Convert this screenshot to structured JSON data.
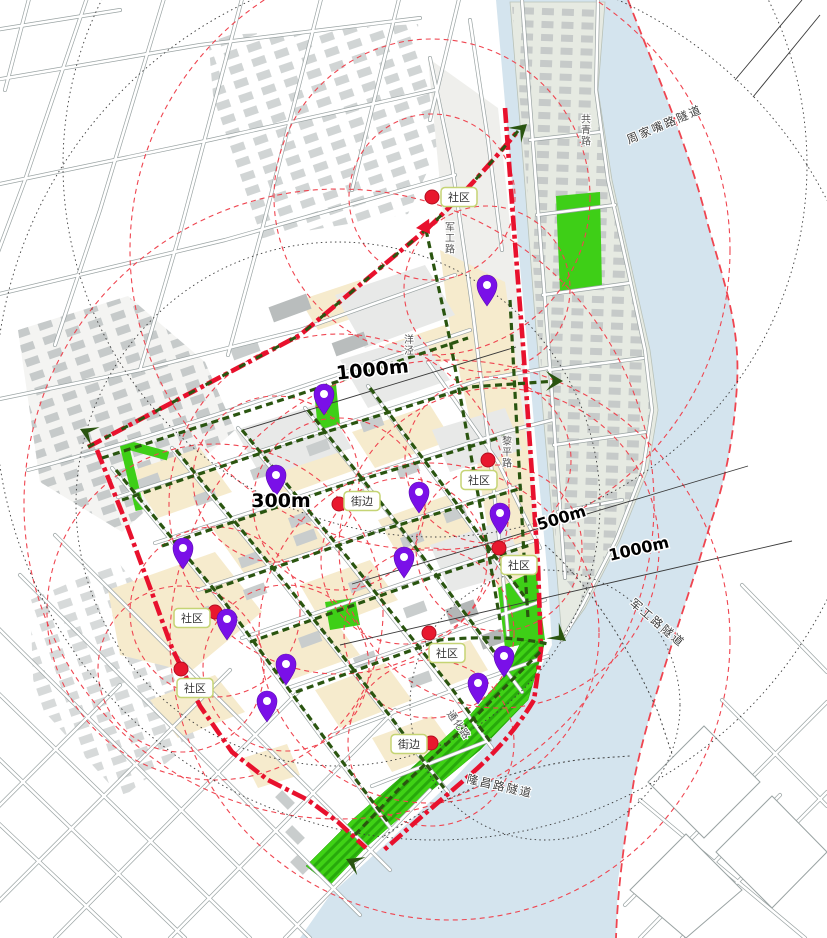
{
  "title": "滨江片区步行系统与服务半径分析图",
  "colors": {
    "boundary_red": "#e8112d",
    "route_green": "#2a5510",
    "radius_red": "#ef4550",
    "pin_purple": "#7a10e8",
    "poi_dot_red": "#e8182e",
    "water_blue": "#d4e4ee",
    "park_green": "#3ecf17",
    "block_tan": "#f6ebcd",
    "building_gray": "#c6caca"
  },
  "labels": {
    "distance": [
      {
        "text": "1000m",
        "x": 373,
        "y": 376,
        "rot": -6,
        "size": 19
      },
      {
        "text": "300m",
        "x": 281,
        "y": 507,
        "rot": 0,
        "size": 19
      },
      {
        "text": "500m",
        "x": 563,
        "y": 523,
        "rot": -17,
        "size": 16
      },
      {
        "text": "1000m",
        "x": 640,
        "y": 554,
        "rot": -13,
        "size": 16
      }
    ],
    "tunnels": [
      {
        "text": "周家嘴路隧道",
        "x": 666,
        "y": 128,
        "rot": -23
      },
      {
        "text": "军工路隧道",
        "x": 655,
        "y": 626,
        "rot": 40
      },
      {
        "text": "隆昌路隧道",
        "x": 499,
        "y": 790,
        "rot": 13
      }
    ],
    "roads": [
      {
        "text": "军工路",
        "x": 448,
        "y": 238,
        "vertical": true
      },
      {
        "text": "共青路",
        "x": 584,
        "y": 130,
        "vertical": true
      },
      {
        "text": "黎平路",
        "x": 505,
        "y": 452,
        "vertical": true
      },
      {
        "text": "洋泾",
        "x": 407,
        "y": 345,
        "vertical": true
      },
      {
        "text": "通化路",
        "x": 456,
        "y": 727,
        "rot": 55
      }
    ]
  },
  "markers": {
    "poi": [
      {
        "label": "社区",
        "dot": [
          432,
          197
        ],
        "box": [
          459,
          197
        ]
      },
      {
        "label": "社区",
        "dot": [
          488,
          460
        ],
        "box": [
          479,
          480
        ]
      },
      {
        "label": "社区",
        "dot": [
          499,
          548
        ],
        "box": [
          519,
          565
        ]
      },
      {
        "label": "街边",
        "dot": [
          339,
          504
        ],
        "box": [
          362,
          501
        ]
      },
      {
        "label": "社区",
        "dot": [
          215,
          612
        ],
        "box": [
          192,
          618
        ]
      },
      {
        "label": "社区",
        "dot": [
          181,
          669
        ],
        "box": [
          195,
          688
        ]
      },
      {
        "label": "社区",
        "dot": [
          429,
          633
        ],
        "box": [
          447,
          653
        ]
      },
      {
        "label": "街边",
        "dot": [
          431,
          743
        ],
        "box": [
          409,
          744
        ]
      }
    ],
    "pins": [
      [
        487,
        289
      ],
      [
        324,
        398
      ],
      [
        276,
        479
      ],
      [
        419,
        496
      ],
      [
        500,
        517
      ],
      [
        404,
        561
      ],
      [
        183,
        552
      ],
      [
        227,
        623
      ],
      [
        286,
        668
      ],
      [
        267,
        705
      ],
      [
        504,
        660
      ],
      [
        478,
        687
      ]
    ]
  },
  "circles": {
    "service": [
      {
        "c": [
          432,
          197
        ],
        "r": 83
      },
      {
        "c": [
          432,
          197
        ],
        "r": 158
      },
      {
        "c": [
          487,
          289
        ],
        "r": 83
      },
      {
        "c": [
          488,
          460
        ],
        "r": 83
      },
      {
        "c": [
          339,
          504
        ],
        "r": 86
      },
      {
        "c": [
          339,
          504
        ],
        "r": 170
      },
      {
        "c": [
          339,
          504
        ],
        "r": 315
      },
      {
        "c": [
          499,
          548
        ],
        "r": 83
      },
      {
        "c": [
          499,
          548
        ],
        "r": 160
      },
      {
        "c": [
          215,
          612
        ],
        "r": 85
      },
      {
        "c": [
          215,
          612
        ],
        "r": 168
      },
      {
        "c": [
          181,
          669
        ],
        "r": 83
      },
      {
        "c": [
          429,
          633
        ],
        "r": 85
      },
      {
        "c": [
          429,
          633
        ],
        "r": 170
      },
      {
        "c": [
          450,
          640
        ],
        "r": 280
      },
      {
        "c": [
          431,
          743
        ],
        "r": 83
      },
      {
        "c": [
          276,
          479
        ],
        "r": 83
      },
      {
        "c": [
          404,
          561
        ],
        "r": 83
      },
      {
        "c": [
          286,
          668
        ],
        "r": 83
      },
      {
        "c": [
          430,
          250
        ],
        "r": 300
      }
    ],
    "dotted": [
      {
        "c": [
          435,
          165
        ],
        "r": 372
      },
      {
        "c": [
          435,
          400
        ],
        "r": 440
      },
      {
        "c": [
          338,
          504
        ],
        "r": 262
      },
      {
        "c": [
          545,
          705
        ],
        "r": 135
      }
    ]
  }
}
